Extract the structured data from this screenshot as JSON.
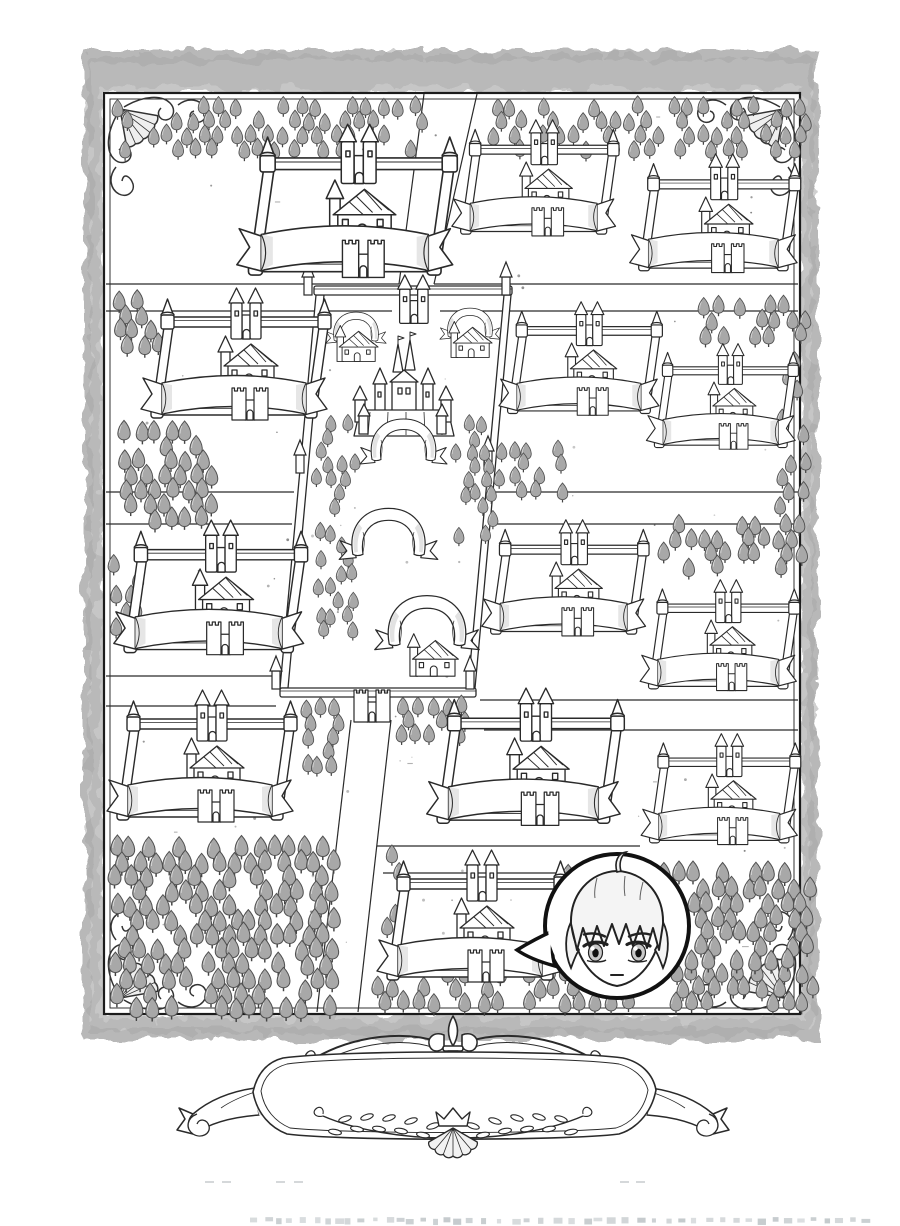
{
  "artwork": {
    "kind": "black-and-white manga fantasy kingdom map page",
    "width": 900,
    "height": 1226,
    "visible_text": "none (all banners and the title cartouche are blank; a cropped illegible credit line is cut off at the bottom edge)"
  },
  "palette": {
    "background": "#ffffff",
    "ink": "#2a2a2a",
    "bubble_ink": "#111111",
    "tree_fill": "#a8a8a8",
    "tree_stroke": "#505050",
    "parchment": "#c6c6c6",
    "parchment_shade": "#b2b2b2",
    "parchment_rim": "#9f9f9f",
    "shade": "#e2e2e2",
    "hair_fill": "#f4f4f4",
    "iris_fill": "#c9c9c9",
    "footer_text_color": "#bfc5c8"
  },
  "border": {
    "outer_rect": [
      84,
      50,
      734,
      990
    ],
    "inner_rect": [
      104,
      93,
      696,
      921
    ],
    "inner_rect2": [
      110,
      99,
      684,
      909
    ],
    "corners": [
      [
        104,
        93,
        1,
        1
      ],
      [
        800,
        93,
        -1,
        1
      ],
      [
        104,
        1014,
        1,
        -1
      ],
      [
        800,
        1014,
        -1,
        -1
      ]
    ]
  },
  "roads": {
    "stroke_width": 1.2,
    "lines": [
      [
        424,
        94,
        399,
        284
      ],
      [
        477,
        94,
        434,
        284
      ],
      [
        351,
        720,
        317,
        1012
      ],
      [
        391,
        720,
        358,
        1012
      ],
      [
        106,
        284,
        399,
        284
      ],
      [
        106,
        311,
        392,
        311
      ],
      [
        434,
        284,
        798,
        284
      ],
      [
        440,
        311,
        798,
        311
      ],
      [
        106,
        492,
        294,
        492
      ],
      [
        106,
        524,
        292,
        524
      ],
      [
        492,
        492,
        798,
        492
      ],
      [
        496,
        524,
        798,
        524
      ],
      [
        106,
        676,
        278,
        676
      ],
      [
        106,
        706,
        276,
        706
      ],
      [
        480,
        700,
        798,
        700
      ],
      [
        484,
        730,
        798,
        730
      ],
      [
        377,
        846,
        640,
        846
      ],
      [
        383,
        873,
        640,
        873
      ]
    ]
  },
  "forest": {
    "clusters": [
      [
        112,
        97,
        19,
        4,
        16.5,
        14,
        0.78,
        0.38,
        0
      ],
      [
        488,
        97,
        20,
        4,
        16,
        14,
        0.78,
        0.38,
        0
      ],
      [
        110,
        290,
        3,
        4,
        16,
        14.5,
        0.85,
        0.25,
        0
      ],
      [
        116,
        420,
        6,
        7,
        15.5,
        14.5,
        0.88,
        0.3,
        0
      ],
      [
        108,
        555,
        2,
        6,
        15,
        15,
        0.8,
        0.35,
        0
      ],
      [
        106,
        836,
        14,
        12,
        16,
        14.5,
        0.92,
        0.2,
        0
      ],
      [
        330,
        962,
        30,
        3,
        16,
        14.5,
        0.85,
        0.3,
        1
      ],
      [
        560,
        862,
        16,
        7,
        15.5,
        14.5,
        0.9,
        0.25,
        0
      ],
      [
        698,
        296,
        7,
        3,
        15.5,
        14,
        0.8,
        0.3,
        0
      ],
      [
        658,
        514,
        10,
        4,
        15,
        14,
        0.82,
        0.35,
        0
      ],
      [
        775,
        352,
        2,
        11,
        15,
        14.5,
        0.78,
        0.45,
        0
      ],
      [
        312,
        413,
        3,
        16,
        13.5,
        13.8,
        0.72,
        0.3,
        0
      ],
      [
        450,
        415,
        3,
        9,
        13.5,
        13.8,
        0.72,
        0.3,
        0
      ],
      [
        492,
        440,
        5,
        4,
        14,
        13.5,
        0.75,
        0.3,
        0
      ],
      [
        298,
        698,
        3,
        5,
        14,
        14,
        0.78,
        0.3,
        0
      ],
      [
        396,
        696,
        5,
        3,
        14,
        13.5,
        0.78,
        0.3,
        0
      ],
      [
        370,
        846,
        2,
        6,
        14.5,
        14,
        0.8,
        0.35,
        1
      ]
    ]
  },
  "estates": [
    [
      245,
      122,
      1.16
    ],
    [
      458,
      118,
      0.88
    ],
    [
      636,
      152,
      0.9
    ],
    [
      148,
      286,
      1.0
    ],
    [
      505,
      300,
      0.86
    ],
    [
      652,
      342,
      0.8
    ],
    [
      121,
      518,
      1.02
    ],
    [
      488,
      518,
      0.88
    ],
    [
      646,
      578,
      0.84
    ],
    [
      114,
      688,
      1.0
    ],
    [
      434,
      686,
      1.04
    ],
    [
      647,
      732,
      0.84
    ],
    [
      384,
      848,
      1.0
    ]
  ],
  "district": {
    "top_wall": [
      314,
      286,
      198,
      9
    ],
    "bottom_wall": [
      280,
      688,
      196,
      9
    ],
    "side_walls": [
      [
        316,
        295,
        324,
        295,
        288,
        688,
        280,
        688
      ],
      [
        504,
        295,
        511,
        295,
        475,
        688,
        468,
        688
      ]
    ],
    "spires": [
      [
        300,
        262
      ],
      [
        498,
        262
      ],
      [
        292,
        440
      ],
      [
        480,
        436
      ],
      [
        268,
        656
      ],
      [
        462,
        656
      ]
    ],
    "gatehouse": [
      392,
      274,
      0.95
    ],
    "south_gate": [
      352,
      682,
      1.0
    ],
    "palace": [
      348,
      342,
      1.0
    ],
    "house_banners": [
      [
        326,
        310,
        1.0
      ],
      [
        440,
        306,
        1.0
      ]
    ],
    "arch_banners": [
      [
        366,
        416,
        0.75
      ],
      [
        346,
        505,
        0.85
      ],
      [
        382,
        592,
        0.9
      ]
    ],
    "church": [
      404,
      632,
      0.85
    ]
  },
  "character_bubble": {
    "cx": 617,
    "cy": 926,
    "r": 72,
    "tail_direction": "left"
  },
  "cartouche": {
    "x": 183,
    "y": 1022,
    "scale": 1.0
  },
  "speckles": {
    "count": 90,
    "area": [
      115,
      105,
      680,
      890
    ],
    "seed": 42
  },
  "footer": {
    "cropped_line_y": 1217,
    "x_start": 250,
    "x_end": 862,
    "secondary_marks_y": 1181,
    "secondary_marks_x": [
      205,
      222,
      276,
      294,
      620,
      636
    ]
  }
}
